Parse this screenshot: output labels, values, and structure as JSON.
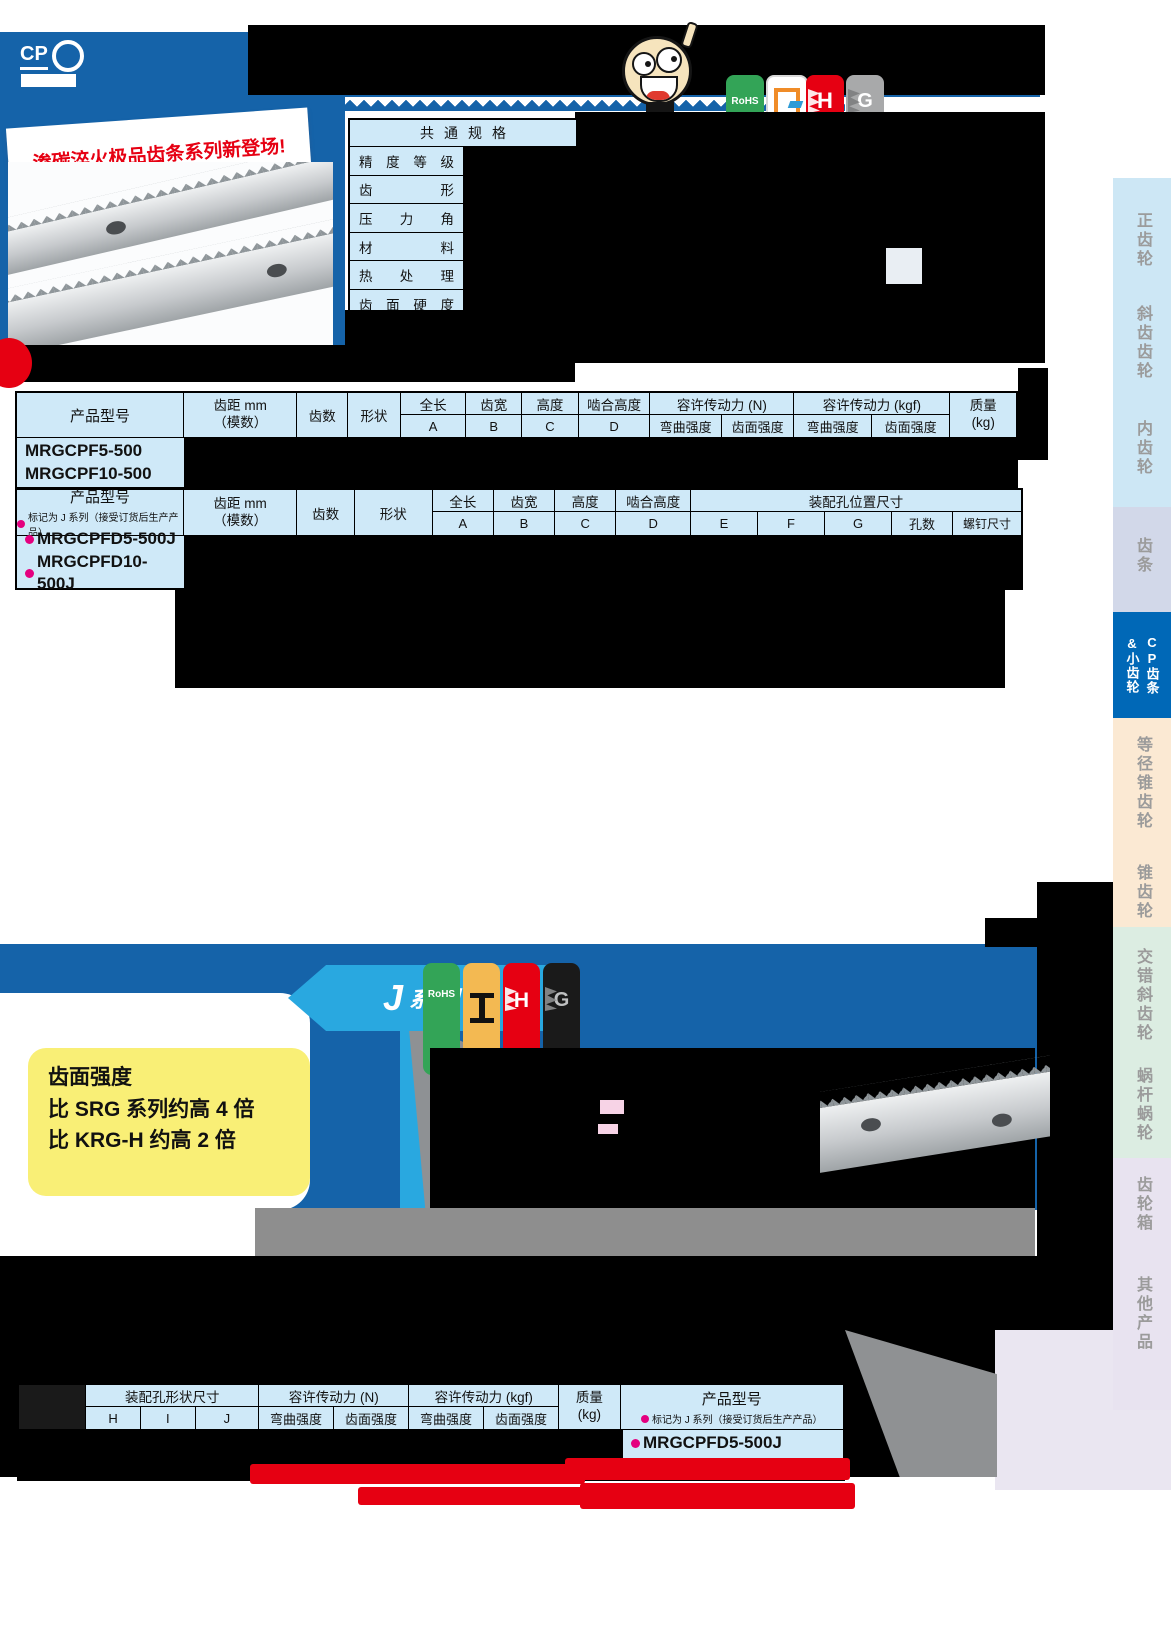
{
  "header": {
    "logo_text": "CP",
    "promo_text": "渗碳淬火极品齿条系列新登场!",
    "badges": [
      {
        "name": "rohs",
        "label": "RoHS",
        "color": "#33a457"
      },
      {
        "name": "finishing",
        "label": "",
        "color": "#ffffff"
      },
      {
        "name": "hardened",
        "label": "H",
        "color": "#e60012"
      },
      {
        "name": "ground",
        "label": "G",
        "color": "#a8a9aa"
      }
    ]
  },
  "common_spec": {
    "title": "共通规格",
    "rows": [
      "精度等级",
      "齿形",
      "压力角",
      "材料",
      "热处理",
      "齿面硬度"
    ]
  },
  "table_headers": {
    "product": "产品型号",
    "pitch_top": "齿距 mm",
    "pitch_bottom": "（模数）",
    "teeth": "齿数",
    "shape": "形状",
    "total_len": "全长",
    "face_width": "齿宽",
    "height": "高度",
    "mesh_height": "啮合高度",
    "A": "A",
    "B": "B",
    "C": "C",
    "D": "D",
    "force_n": "容许传动力 (N)",
    "force_kgf": "容许传动力 (kgf)",
    "bending": "弯曲强度",
    "surface": "齿面强度",
    "mass_top": "质量",
    "mass_bottom": "(kg)",
    "mount_pos": "装配孔位置尺寸",
    "E": "E",
    "F": "F",
    "G": "G",
    "holes": "孔数",
    "screw": "螺钉尺寸",
    "mount_shape": "装配孔形状尺寸",
    "H": "H",
    "I": "I",
    "J": "J",
    "j_note": "标记为 J 系列（接受订货后生产产品）"
  },
  "table1": {
    "products": [
      "MRGCPF5-500",
      "MRGCPF10-500"
    ]
  },
  "table2": {
    "products": [
      "MRGCPFD5-500J",
      "MRGCPFD10-500J"
    ]
  },
  "table3": {
    "products": [
      "MRGCPFD5-500J",
      "MRGCPFD10-500J"
    ]
  },
  "jseries": {
    "banner_j": "J",
    "banner_rest": "系列",
    "highlight_lines": [
      "齿面强度",
      "比 SRG 系列约高 4 倍",
      "比 KRG-H 约高 2 倍"
    ],
    "badges": [
      {
        "name": "rohs",
        "label": "RoHS",
        "color": "#33a457"
      },
      {
        "name": "hobbed",
        "label": "",
        "color": "#f3b952"
      },
      {
        "name": "hardened",
        "label": "H",
        "color": "#e60012"
      },
      {
        "name": "ground",
        "label": "G",
        "color": "#1a1a1a"
      }
    ]
  },
  "sidebar": {
    "items": [
      {
        "label": "正齿轮"
      },
      {
        "label": "斜齿齿轮"
      },
      {
        "label": "内齿轮"
      },
      {
        "label": "齿条"
      },
      {
        "label": "CP齿条",
        "label2": "&小齿轮",
        "active": true
      },
      {
        "label": "等径锥齿轮"
      },
      {
        "label": "锥齿轮"
      },
      {
        "label": "交错斜齿轮"
      },
      {
        "label": "蜗杆蜗轮"
      },
      {
        "label": "齿轮箱"
      },
      {
        "label": "其他产品"
      }
    ]
  }
}
